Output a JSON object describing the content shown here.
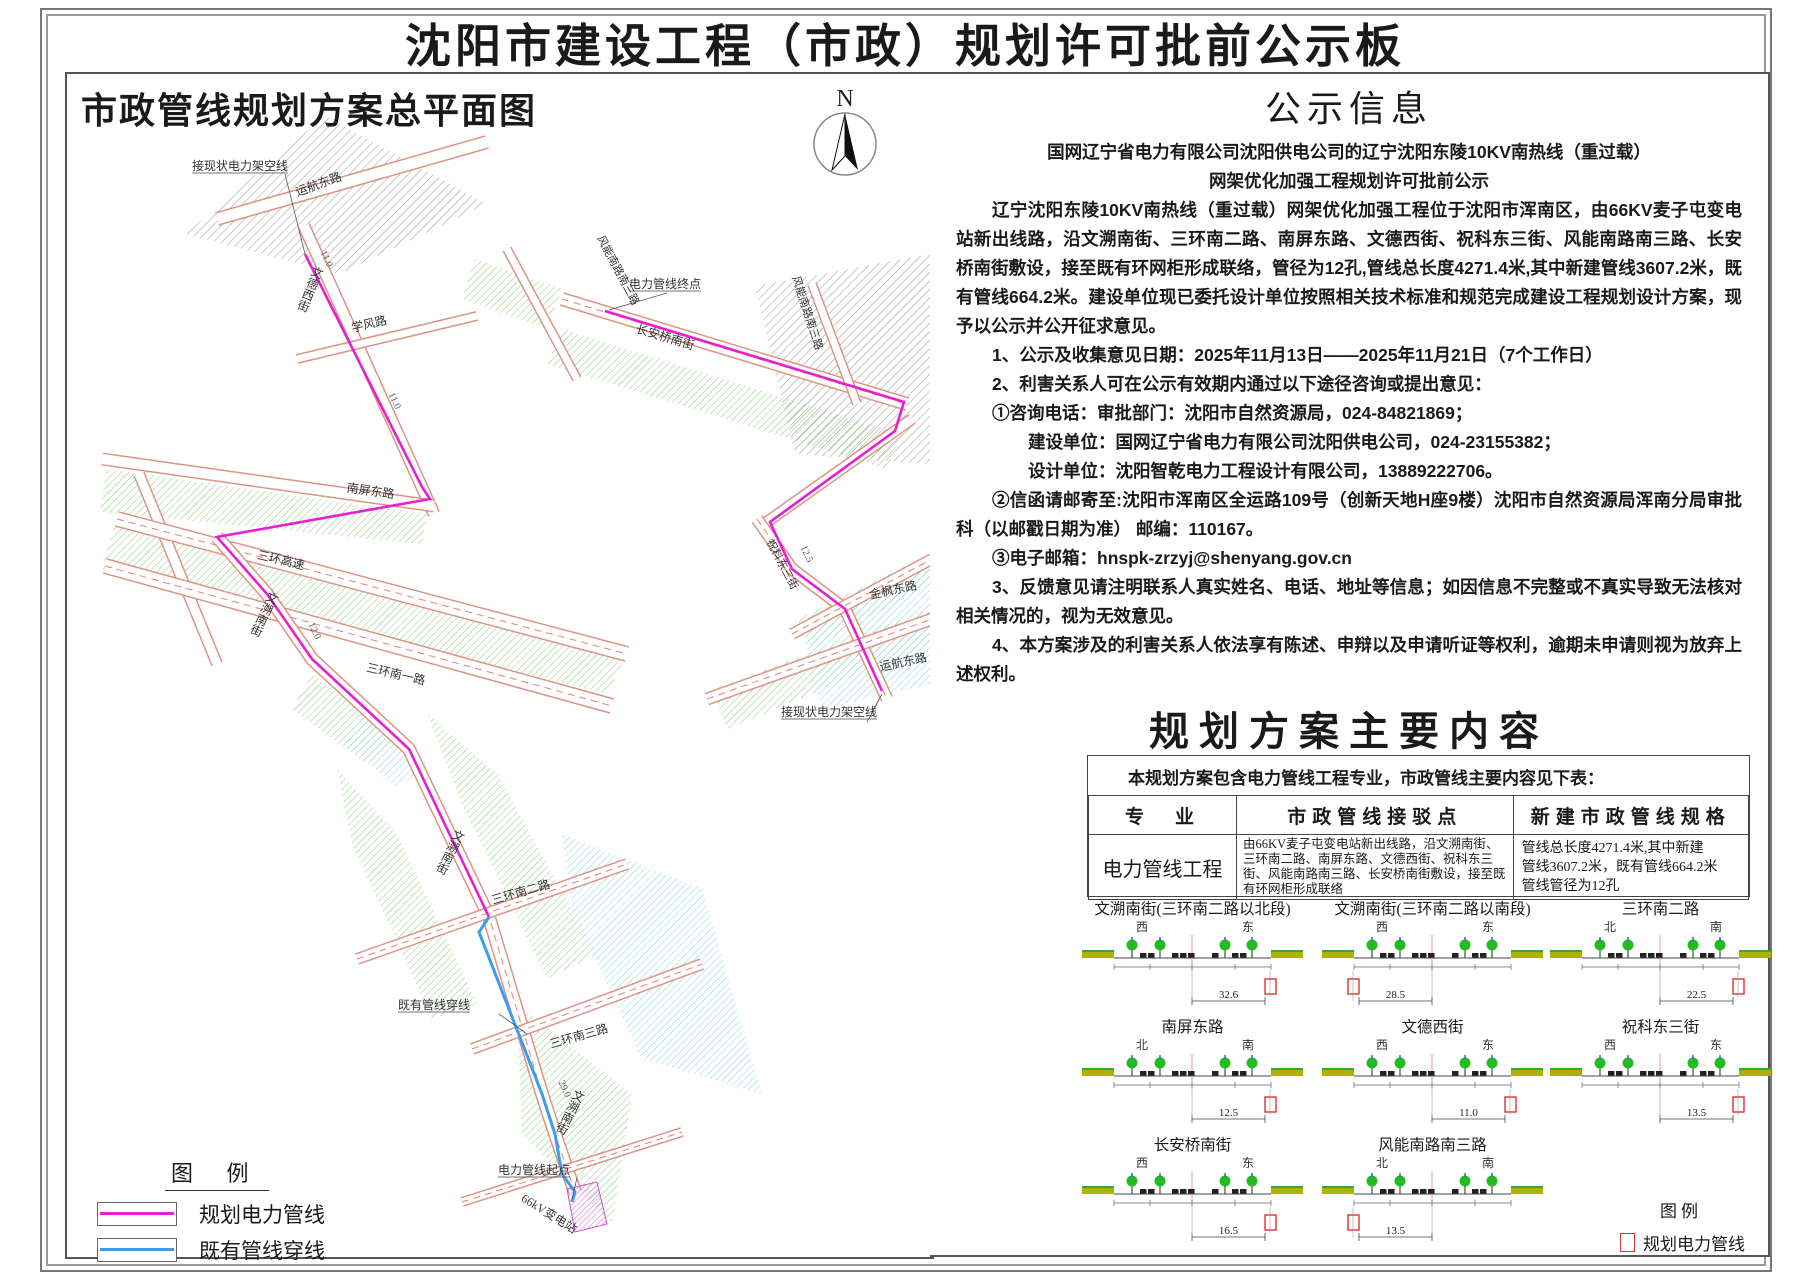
{
  "title": "沈阳市建设工程（市政）规划许可批前公示板",
  "map_panel": {
    "title": "市政管线规划方案总平面图",
    "compass_label": "N",
    "legend": {
      "title": "图  例",
      "items": [
        {
          "label": "规划电力管线",
          "color": "#e71ed3"
        },
        {
          "label": "既有管线穿线",
          "color": "#3b9df0"
        }
      ]
    },
    "labels": [
      "接现状电力架空线",
      "运航东路",
      "文德西街",
      "学风路",
      "南屏东路",
      "三环高速",
      "三环南一路",
      "文溯南街",
      "三环南二路",
      "既有管线穿线",
      "三环南三路",
      "文溯南街",
      "文溯南街",
      "电力管线起点",
      "66kV变电站",
      "电力管线终点",
      "风能南路南三路",
      "长安桥南街",
      "风能南路南三路",
      "祝科东三街",
      "金枫东路",
      "运航东路",
      "接现状电力架空线"
    ],
    "dims": [
      "11.0",
      "11.0",
      "12.0",
      "29.0",
      "12.5"
    ]
  },
  "notice": {
    "title": "公示信息",
    "paragraphs": [
      {
        "t": "国网辽宁省电力有限公司沈阳供电公司的辽宁沈阳东陵10KV南热线（重过载）",
        "c": "p-center"
      },
      {
        "t": "网架优化加强工程规划许可批前公示",
        "c": "p-center"
      },
      {
        "t": "辽宁沈阳东陵10KV南热线（重过载）网架优化加强工程位于沈阳市浑南区，由66KV麦子屯变电站新出线路，沿文溯南街、三环南二路、南屏东路、文德西街、祝科东三街、风能南路南三路、长安桥南街敷设，接至既有环网柜形成联络，管径为12孔,管线总长度4271.4米,其中新建管线3607.2米，既有管线664.2米。建设单位现已委托设计单位按照相关技术标准和规范完成建设工程规划设计方案，现予以公示并公开征求意见。",
        "c": "p-indent"
      },
      {
        "t": "1、公示及收集意见日期：2025年11月13日——2025年11月21日（7个工作日）",
        "c": "p-indent"
      },
      {
        "t": "2、利害关系人可在公示有效期内通过以下途径咨询或提出意见：",
        "c": "p-indent"
      },
      {
        "t": "①咨询电话：审批部门：沈阳市自然资源局，024-84821869；",
        "c": "p-indent"
      },
      {
        "t": "建设单位：国网辽宁省电力有限公司沈阳供电公司，024-23155382；",
        "c": "p-indent2"
      },
      {
        "t": "设计单位：沈阳智乾电力工程设计有限公司，13889222706。",
        "c": "p-indent2"
      },
      {
        "t": "②信函请邮寄至:沈阳市浑南区全运路109号（创新天地H座9楼）沈阳市自然资源局浑南分局审批科（以邮戳日期为准）  邮编：110167。",
        "c": "p-indent"
      },
      {
        "t": "③电子邮箱：hnspk-zrzyj@shenyang.gov.cn",
        "c": "p-indent"
      },
      {
        "t": "3、反馈意见请注明联系人真实姓名、电话、地址等信息；如因信息不完整或不真实导致无法核对相关情况的，视为无效意见。",
        "c": "p-indent"
      },
      {
        "t": "4、本方案涉及的利害关系人依法享有陈述、申辩以及申请听证等权利，逾期未申请则视为放弃上述权利。",
        "c": "p-indent"
      }
    ],
    "signatures": [
      "国网辽宁省电力有限公司沈阳供电公司",
      "沈阳市自然资源局",
      "2025年11月13日"
    ]
  },
  "plan": {
    "title": "规划方案主要内容",
    "intro": "本规划方案包含电力管线工程专业，市政管线主要内容见下表：",
    "table": {
      "headers": [
        "专　业",
        "市政管线接驳点",
        "新建市政管线规格"
      ],
      "row": {
        "specialty": "电力管线工程",
        "connection": "由66KV麦子屯变电站新出线路，沿文溯南街、三环南二路、南屏东路、文德西街、祝科东三街、风能南路南三路、长安桥南街敷设，接至既有环网柜形成联络",
        "spec_line1": "管线总长度4271.4米,其中新建",
        "spec_line2": "管线3607.2米，既有管线664.2米",
        "spec_line3": "管线管径为12孔"
      }
    },
    "sections": [
      {
        "title": "文溯南街(三环南二路以北段)",
        "left": "西",
        "right": "东",
        "dim": "32.6",
        "side": "right"
      },
      {
        "title": "文溯南街(三环南二路以南段)",
        "left": "西",
        "right": "东",
        "dim": "28.5",
        "side": "left"
      },
      {
        "title": "三环南二路",
        "left": "北",
        "right": "南",
        "dim": "22.5",
        "side": "right"
      },
      {
        "title": "南屏东路",
        "left": "北",
        "right": "南",
        "dim": "12.5",
        "side": "right"
      },
      {
        "title": "文德西街",
        "left": "西",
        "right": "东",
        "dim": "11.0",
        "side": "right"
      },
      {
        "title": "祝科东三街",
        "left": "西",
        "right": "东",
        "dim": "13.5",
        "side": "right"
      },
      {
        "title": "长安桥南街",
        "left": "西",
        "right": "东",
        "dim": "16.5",
        "side": "right"
      },
      {
        "title": "风能南路南三路",
        "left": "北",
        "right": "南",
        "dim": "13.5",
        "side": "left"
      }
    ],
    "legend": {
      "title": "图例",
      "item": "规划电力管线"
    }
  }
}
